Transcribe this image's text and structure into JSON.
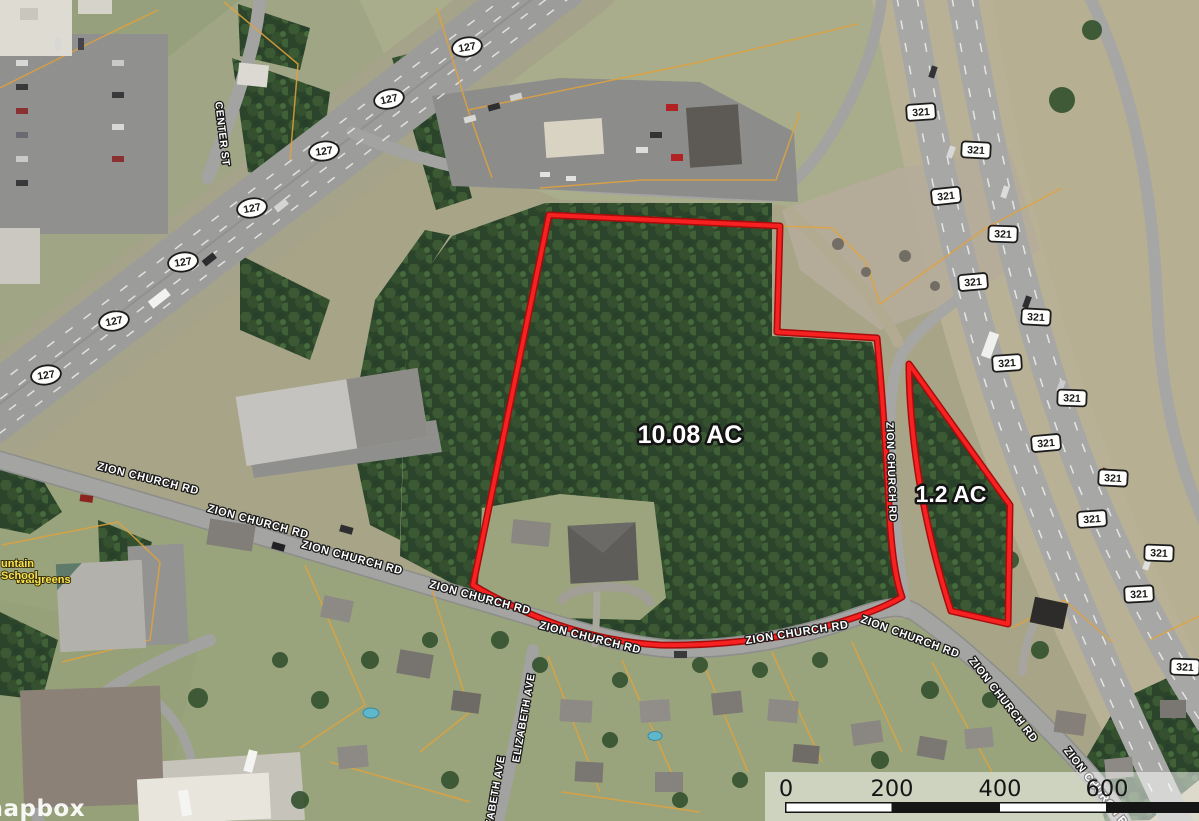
{
  "map": {
    "attribution": "mapbox",
    "parcels": [
      {
        "name": "main parcel",
        "acreage_label": "10.08 AC"
      },
      {
        "name": "east parcel",
        "acreage_label": "1.2 AC"
      }
    ],
    "roads": {
      "zion_church_rd": "ZION CHURCH RD",
      "center_st": "CENTER ST",
      "elizabeth_ave": "ELIZABETH AVE",
      "route_127": "127",
      "route_321": "321"
    },
    "poi": {
      "walgreens": "Walgreens",
      "edge_label_line1": "untain",
      "edge_label_line2": "School"
    },
    "scale_bar": {
      "ticks": [
        "0",
        "200",
        "400",
        "600"
      ]
    },
    "colors": {
      "boundary_red": "#f82121",
      "parcel_line_yellow": "#e2a23b",
      "road_label_fill": "#ffffff",
      "label_halo": "#1b1b1b"
    }
  }
}
